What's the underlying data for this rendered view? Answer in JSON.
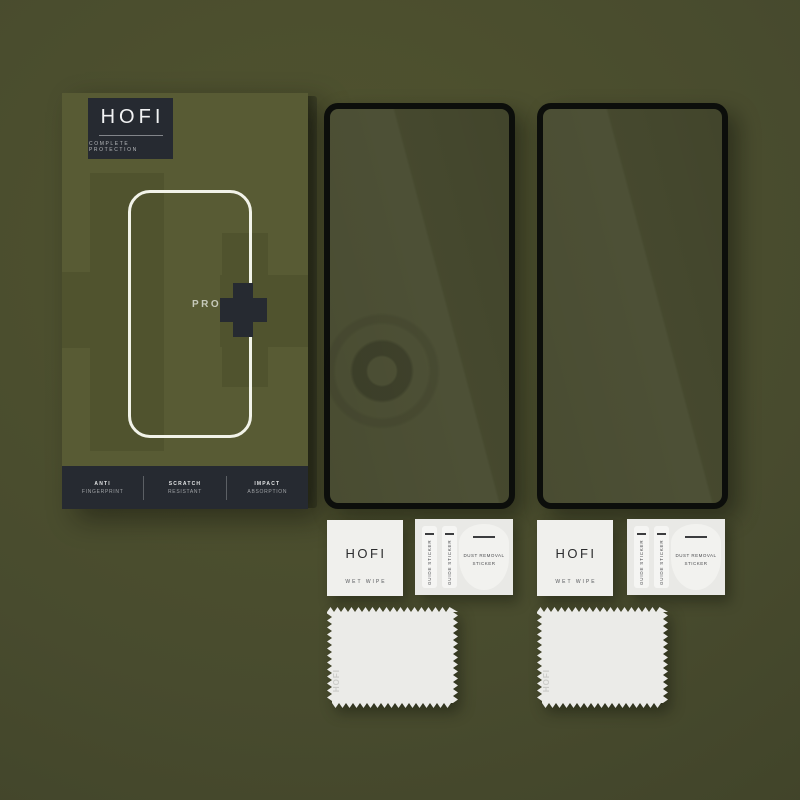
{
  "product": {
    "brand": "HOFI",
    "tagline": "COMPLETE PROTECTION",
    "line_label": "PRO",
    "features": [
      {
        "line1": "ANTI",
        "line2": "FINGERPRINT"
      },
      {
        "line1": "SCRATCH",
        "line2": "RESISTANT"
      },
      {
        "line1": "IMPACT",
        "line2": "ABSORPTION"
      }
    ]
  },
  "accessories": {
    "wet_wipe": {
      "brand": "HOFI",
      "label": "WET WIPE"
    },
    "sticker_sheet": {
      "guide_sticker_label": "GUIDE STICKER",
      "dust_sticker_line1": "DUST REMOVAL",
      "dust_sticker_line2": "STICKER"
    },
    "cloth": {
      "brand": "HOFI"
    }
  },
  "colors": {
    "background_olive": "#484b2e",
    "box_olive": "#585b34",
    "dark_accent": "#262a31",
    "glass_tint": "#474a2f",
    "glass_border": "#0c0e0b",
    "packet_white": "#f0f0ed",
    "outline_white": "#f2f3e9"
  }
}
